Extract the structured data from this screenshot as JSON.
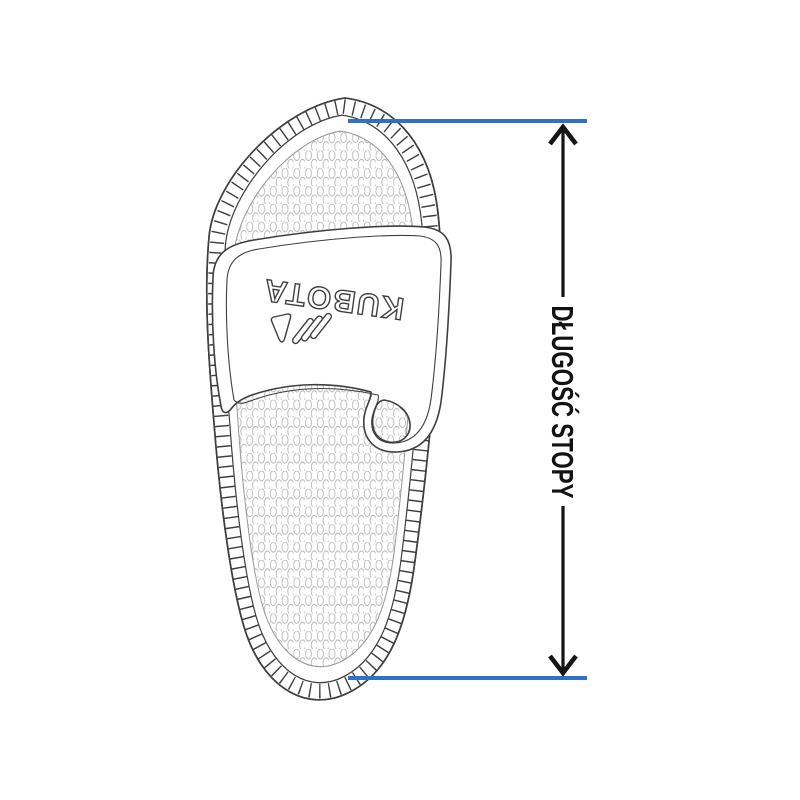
{
  "brand_logo": {
    "text": "KUBOTA"
  },
  "measurement": {
    "label": "DŁUGOŚĆ STOPY"
  },
  "colors": {
    "accent_blue": "#2f70c8",
    "outline_dark": "#3f3f3f",
    "arrow_black": "#151515",
    "label_black": "#121212",
    "texture_gray": "#b5b5b5",
    "footbed_edge": "#9a9a9a"
  }
}
